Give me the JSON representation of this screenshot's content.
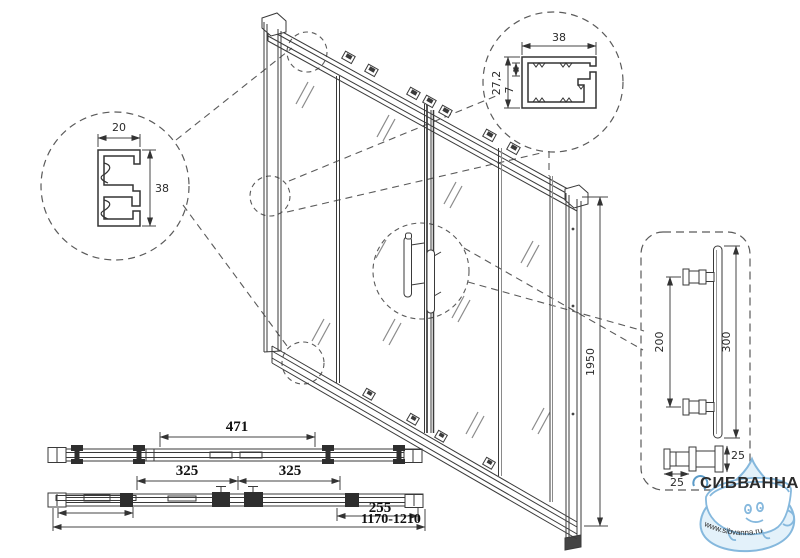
{
  "dims": {
    "wall_profile": {
      "width": "20",
      "height": "38"
    },
    "top_profile": {
      "width": "38",
      "height": "27,2",
      "lip": "7"
    },
    "door_height": "1950",
    "handle": {
      "hole_spacing": "200",
      "length": "300",
      "post_len": "25",
      "post_dia": "25"
    },
    "plan": {
      "top_span": "471",
      "left_span": "325",
      "right_span": "325",
      "end_span": "255",
      "width_range": "1170-1210"
    }
  },
  "logo": {
    "brand": "СИБВАННА",
    "website": "www.sibvanna.ru"
  },
  "colors": {
    "line": "#3a3a3a",
    "dash": "#5a5a5a",
    "brand_red": "#c43b3d",
    "logo_blue": "#85b8dd",
    "logo_text_blue": "#5b9bc8"
  }
}
